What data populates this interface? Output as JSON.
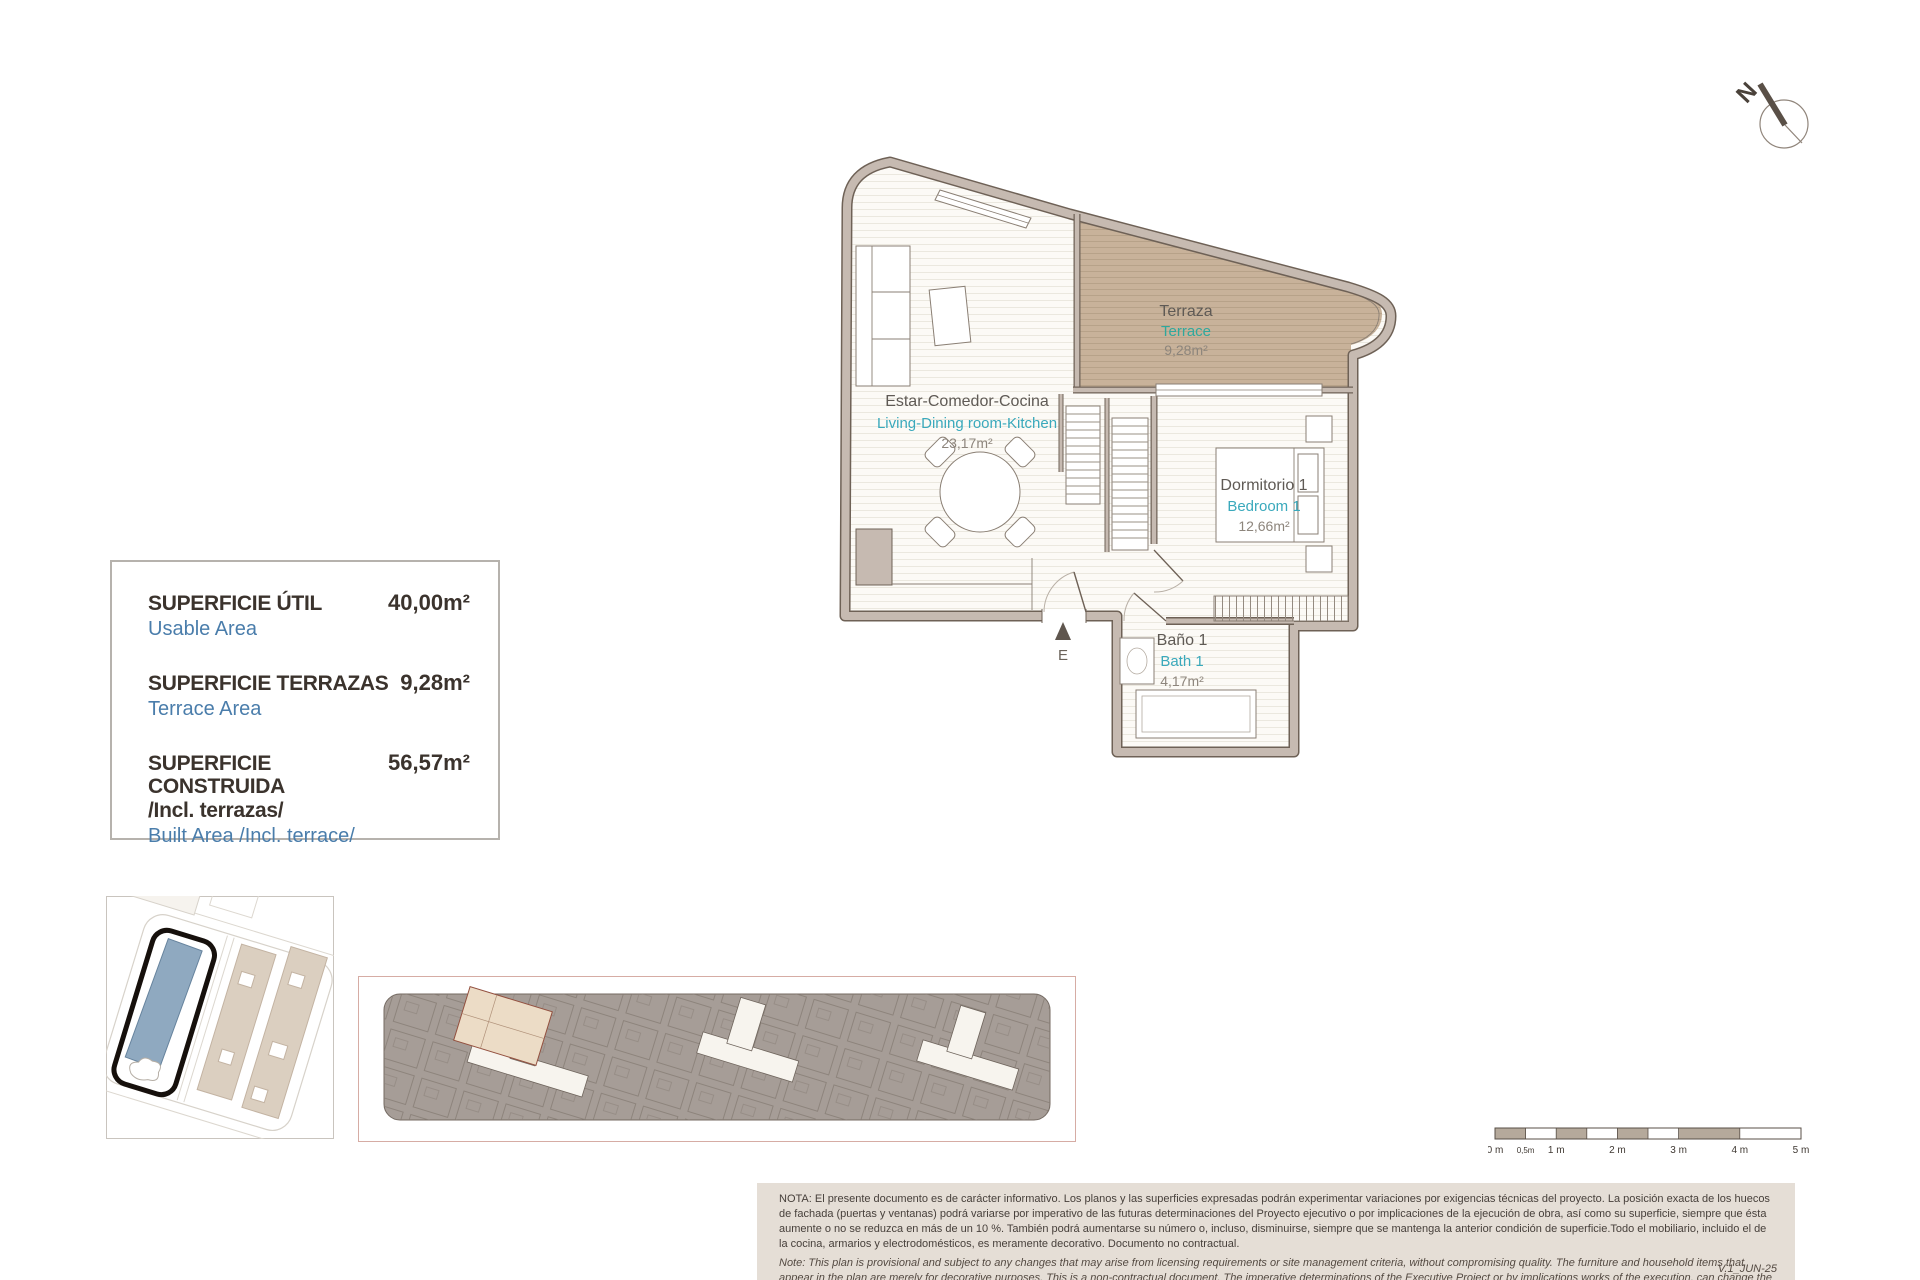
{
  "north": {
    "label": "N"
  },
  "floor_plan": {
    "entrance_marker": "E",
    "rooms": {
      "living": {
        "es": "Estar-Comedor-Cocina",
        "en": "Living-Dining room-Kitchen",
        "area": "23,17m²"
      },
      "terrace": {
        "es": "Terraza",
        "en": "Terrace",
        "area": "9,28m²"
      },
      "bedroom": {
        "es": "Dormitorio 1",
        "en": "Bedroom 1",
        "area": "12,66m²"
      },
      "bath": {
        "es": "Baño 1",
        "en": "Bath 1",
        "area": "4,17m²"
      }
    }
  },
  "area_table": {
    "usable": {
      "es": "SUPERFICIE ÚTIL",
      "en": "Usable Area",
      "value": "40,00m²"
    },
    "terrace": {
      "es": "SUPERFICIE TERRAZAS",
      "en": "Terrace Area",
      "value": "9,28m²"
    },
    "built": {
      "es": "SUPERFICIE CONSTRUIDA",
      "es2": "/Incl. terrazas/",
      "en": "Built Area /Incl. terrace/",
      "value": "56,57m²"
    }
  },
  "scale_bar": {
    "labels": [
      "0 m",
      "0,5m",
      "1 m",
      "2 m",
      "3 m",
      "4 m",
      "5 m"
    ]
  },
  "notes": {
    "es": "NOTA:  El presente documento es de carácter informativo. Los planos y las superficies expresadas podrán experimentar variaciones por exigencias técnicas del proyecto. La posición exacta de los huecos de fachada (puertas y ventanas) podrá variarse por imperativo de las futuras determinaciones del Proyecto ejecutivo o por implicaciones de la ejecución de obra, así como su superficie, siempre que ésta aumente o no se reduzca en más de un 10 %. También podrá aumentarse su número o, incluso, disminuirse, siempre que se mantenga la anterior condición de superficie.Todo el mobiliario, incluido el de la cocina, armarios y electrodomésticos, es meramente decorativo. Documento no contractual.",
    "en": "Note: This plan is provisional and subject to any changes that may arise from licensing requirements or site management criteria, without compromising quality. The furniture and household items that appear in the plan are merely for decorative purposes. This is a non-contractual document. The imperative determinations of the Executive Project or by implications works of the execution, can change the exact position of the facade of doors and windows, as well the surface area may also be increased or even decrease not more than a 10%.",
    "version": "V.1_JUN-25"
  },
  "colors": {
    "label_es": "#5f5a55",
    "label_en_teal": "#2fa89d",
    "label_en_cyan": "#3aa9bc",
    "area_value": "#8d857c",
    "info_blue": "#4a7dab",
    "info_dark": "#3b332d",
    "wall_fill": "#c6bab1",
    "terrace_fill": "#c8b29a",
    "site_highlight_blue": "#8fa9c0",
    "keyplan_highlight": "#ecdcc6",
    "note_bg": "#e5ded6"
  }
}
